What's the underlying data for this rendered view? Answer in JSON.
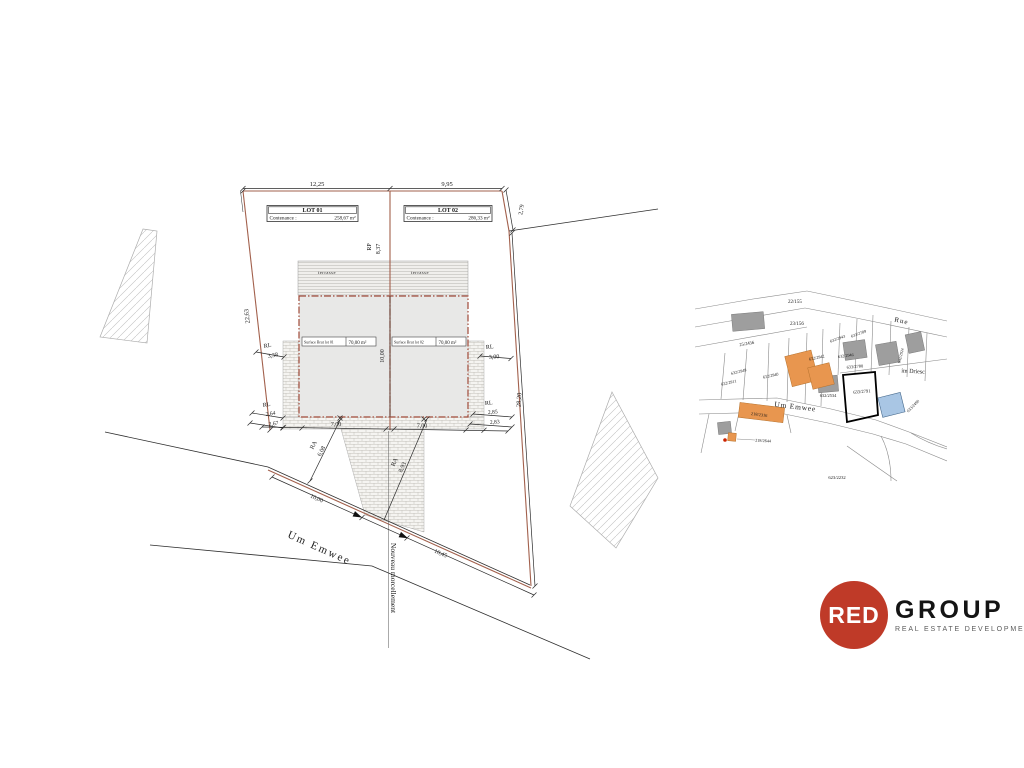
{
  "plan": {
    "lots": [
      {
        "title": "LOT 01",
        "contenance_label": "Contenance :",
        "area": "258,67 m²",
        "surface_label": "Surface Brut lot 01",
        "surface_area": "70,00 m²",
        "terrace": "terrasse"
      },
      {
        "title": "LOT 02",
        "contenance_label": "Contenance :",
        "area": "286,33 m²",
        "surface_label": "Surface Brut lot 02",
        "surface_area": "70,00 m²",
        "terrace": "terrasse"
      }
    ],
    "dimensions": {
      "top_left": "12,25",
      "top_right": "9,95",
      "right_upper": "2,79",
      "right_side": "28,20",
      "left_side": "22,63",
      "building_depth": "10,00",
      "axis_label": "RP",
      "axis_value": "8,37",
      "rl": "RL",
      "ra": "RA",
      "rl_left_top": "3,38",
      "rl_right_top": "3,00",
      "rl_left_bottom_a": "2,64",
      "rl_left_bottom_b": "2,67",
      "rl_right_bottom_a": "2,85",
      "rl_right_bottom_b": "2,83",
      "building_width_1": "7,00",
      "building_width_2": "7,00",
      "road_left": "10,00",
      "road_right": "10,45",
      "ra_left": "6,08",
      "ra_right": "8,93"
    },
    "street_name": "Um Emwee",
    "note": "Nouveau morcellement"
  },
  "map": {
    "street_main": "Um Emwee",
    "street_rue": "Rue",
    "locality": "im Driesc",
    "labels": {
      "p22_155": "22/155",
      "p23_156": "23/156",
      "p25_2456": "25/2456",
      "p632_2949": "632/2949",
      "p632_2911": "632/2911",
      "p632_2940": "632/2940",
      "p632_2942": "632/2942",
      "p632_2943": "632/2943",
      "p633_2789": "633/2789",
      "p632_2946": "632/2946",
      "p633_2780": "633/2780",
      "p633_2791": "633/2791",
      "p632_2534": "632/2534",
      "p632_2924": "632/2924",
      "p633_2490": "633/2490",
      "p218_2316": "218/2316",
      "p218_2644": "218/2644",
      "p623_2232": "623/2232"
    }
  },
  "logo": {
    "red": "RED",
    "group": "GROUP",
    "subtitle": "REAL ESTATE DEVELOPMENT",
    "brand_red": "#bf3a28"
  }
}
